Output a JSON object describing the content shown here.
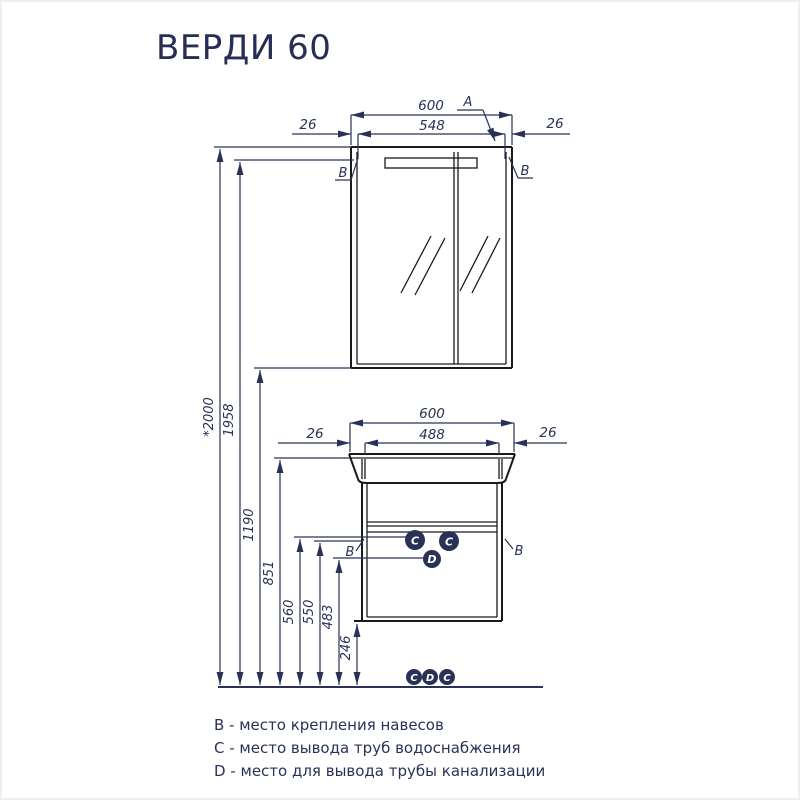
{
  "title": "ВЕРДИ 60",
  "mirror_cabinet": {
    "overall_width": "600",
    "mount_spacing": "548",
    "offset_left": "26",
    "offset_right": "26",
    "detail_label": "A",
    "mount_left": "B",
    "mount_right": "B"
  },
  "vanity": {
    "overall_width": "600",
    "inner_width": "488",
    "offset_left": "26",
    "offset_right": "26",
    "mount_left": "B",
    "mount_right": "B",
    "water_left": "C",
    "water_right": "C",
    "drain": "D"
  },
  "heights": {
    "overall": "*2000",
    "mirror_top": "1958",
    "mirror_bottom": "1190",
    "basin_top": "851",
    "water_supply": "560",
    "cabinet_mount": "550",
    "drain": "483",
    "cabinet_bottom": "246"
  },
  "floor_markers": {
    "left": "C",
    "middle": "D",
    "right": "C"
  },
  "legend": {
    "b": "B - место крепления навесов",
    "c": "C - место вывода труб водоснабжения",
    "d": "D - место для вывода трубы канализации"
  },
  "colors": {
    "accent_navy": "#2a3157",
    "drawing_black": "#1a1a1a",
    "background": "#ffffff"
  }
}
